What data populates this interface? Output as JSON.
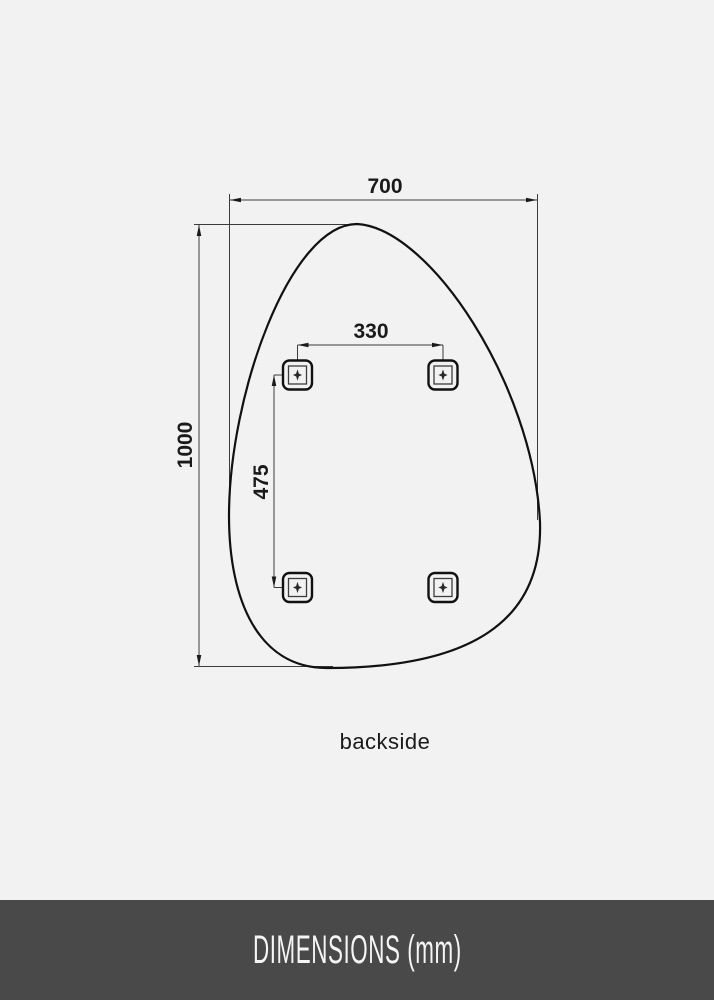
{
  "diagram": {
    "overall_width_mm": "700",
    "overall_height_mm": "1000",
    "bracket_spacing_horizontal_mm": "330",
    "bracket_spacing_vertical_mm": "475",
    "caption": "backside"
  },
  "footer": {
    "label": "DIMENSIONS (mm)"
  },
  "colors": {
    "background": "#f2f2f2",
    "outline": "#111111",
    "dimension_line": "#3c3c3c",
    "text": "#1a1a1a",
    "footer_background": "#494949",
    "footer_text": "#f5f5f5"
  }
}
